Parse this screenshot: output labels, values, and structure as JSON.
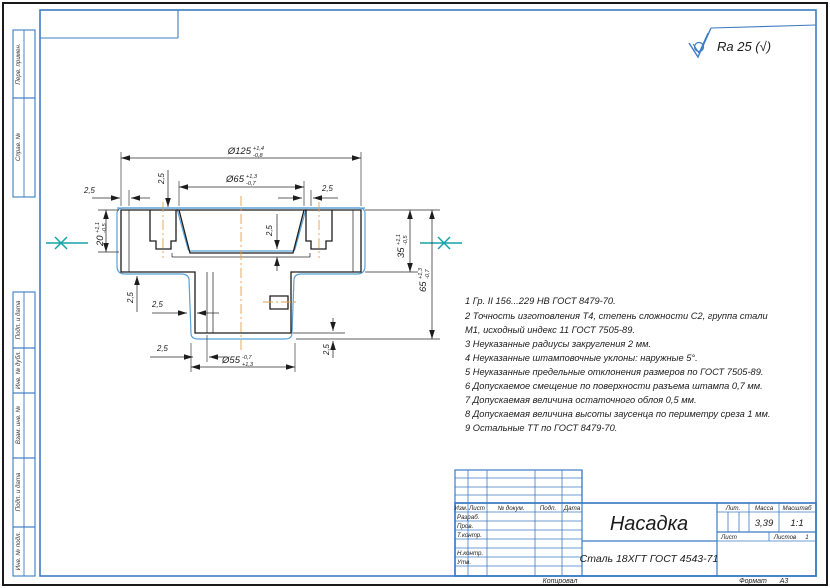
{
  "colors": {
    "frame_blue": "#3d7cc4",
    "part_contour_blue": "#58a0d8",
    "parting_line_teal": "#14a3a8",
    "centerline_orange": "#e2a24b",
    "line_black": "#1d1d1d"
  },
  "roughness": {
    "label": "Ra 25 (√)"
  },
  "margin_labels": [
    "Перв. примен.",
    "Справ. №",
    "Подп. и дата",
    "Инв. № дубл.",
    "Взам. инв. №",
    "Подп. и дата",
    "Инв. № подл."
  ],
  "drawing": {
    "dims": {
      "d125": {
        "v": "Ø125",
        "up": "+1,4",
        "dn": "-0,8"
      },
      "d65": {
        "v": "Ø65",
        "up": "+1,3",
        "dn": "-0,7"
      },
      "d55": {
        "v": "Ø55",
        "up": "+1,3",
        "dn": "-0,7"
      },
      "h20": {
        "v": "20",
        "up": "+1,1",
        "dn": "-0,5"
      },
      "h35": {
        "v": "35",
        "up": "+1,1",
        "dn": "-0,5"
      },
      "h65": {
        "v": "65",
        "up": "+1,3",
        "dn": "-0,7"
      },
      "allow": "2,5"
    }
  },
  "tech_requirements": {
    "lines": [
      "1 Гр. II 156...229 НВ ГОСТ 8479-70.",
      "2  Точность изготовления Т4, степень сложности С2,  группа стали",
      "М1, исходный индекс 11 ГОСТ 7505-89.",
      "3  Неуказанные радиусы закругления 2 мм.",
      "4  Неуказанные штамповочные уклоны: наружные 5°.",
      "5  Неуказанные предельные отклонения размеров по ГОСТ 7505-89.",
      "6  Допускаемое смещение по поверхности разъема штампа 0,7 мм.",
      "7  Допускаемая величина остаточного облоя 0,5 мм.",
      "8  Допускаемая величина высоты заусенца по периметру среза 1 мм.",
      "9  Остальные ТТ по ГОСТ 8479-70."
    ]
  },
  "title_block": {
    "name": "Насадка",
    "material": "Сталь 18ХГТ ГОСТ 4543-71",
    "mass": "3,39",
    "scale": "1:1",
    "sheets_value": "1",
    "labels": {
      "izm": "Изм.",
      "list": "Лист",
      "ndok": "№ докум.",
      "podp": "Подп.",
      "data": "Дата",
      "razrab": "Разраб.",
      "prov": "Пров.",
      "tkontr": "Т.контр.",
      "nkontr": "Н.контр.",
      "utv": "Утв.",
      "lit": "Лит.",
      "massa": "Масса",
      "masshtab": "Масштаб",
      "list2": "Лист",
      "listov": "Листов",
      "kopiroval": "Копировал",
      "format": "Формат",
      "format_value": "А3"
    }
  }
}
